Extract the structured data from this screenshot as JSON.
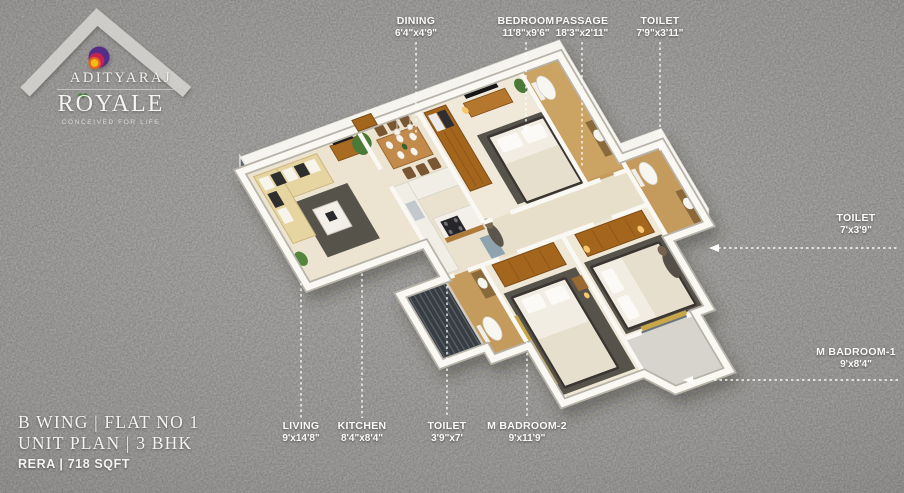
{
  "logo": {
    "brand": "ADITYARAJ",
    "name": "ROYALE",
    "tagline": "CONCEIVED FOR LIFE",
    "colors": {
      "circle_outer": "#532f86",
      "circle_mid": "#c22459",
      "circle_ring": "#e5641c",
      "circle_core": "#f3bd13",
      "chevron": "#d2d1ce"
    }
  },
  "info": {
    "line1": "B WING | FLAT NO 1",
    "line2": "UNIT PLAN | 3 BHK",
    "line3": "RERA | 718 SQFT"
  },
  "labels": {
    "dining": {
      "name": "DINING",
      "dims": "6'4\"x4'9\""
    },
    "bedroom": {
      "name": "BEDROOM",
      "dims": "11'8\"x9'6\""
    },
    "passage": {
      "name": "PASSAGE",
      "dims": "18'3\"x2'11\""
    },
    "toilet_top": {
      "name": "TOILET",
      "dims": "7'9\"x3'11\""
    },
    "toilet_right": {
      "name": "TOILET",
      "dims": "7'x3'9\""
    },
    "mbadroom1": {
      "name": "M BADROOM-1",
      "dims": "9'x8'4\""
    },
    "living": {
      "name": "LIVING",
      "dims": "9'x14'8\""
    },
    "kitchen": {
      "name": "KITCHEN",
      "dims": "8'4\"x8'4\""
    },
    "toilet_bottom": {
      "name": "TOILET",
      "dims": "3'9\"x7'"
    },
    "mbadroom2": {
      "name": "M BADROOM-2",
      "dims": "9'x11'9\""
    }
  },
  "palette": {
    "background": "#9c9b99",
    "floor": "#ece4d1",
    "toilet_tile": "#c49b5b",
    "wood": "#a4661f",
    "wall": "#faf8f2",
    "rug": "#57534c",
    "label_text": "#fbfaf8"
  }
}
